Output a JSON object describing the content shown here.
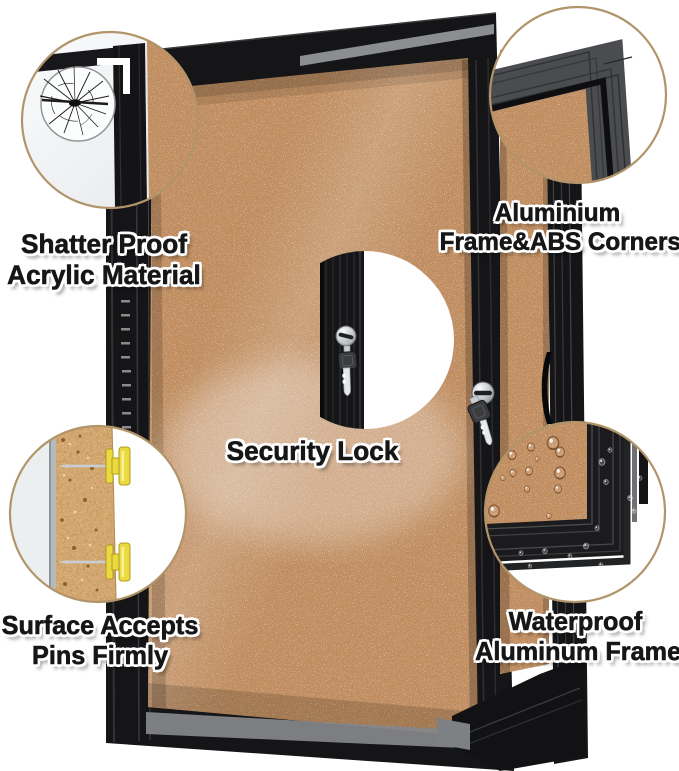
{
  "labels": {
    "shatter": {
      "line1": "Shatter Proof",
      "line2": "Acrylic Material"
    },
    "aluminium": {
      "line1": "Aluminium",
      "line2": "Frame&ABS Corners"
    },
    "security": {
      "label": "Security Lock"
    },
    "pins": {
      "line1": "Surface Accepts",
      "line2": "Pins Firmly"
    },
    "waterproof": {
      "line1": "Waterproof",
      "line2": "Aluminum Frame"
    }
  },
  "colors": {
    "background": "#ffffff",
    "cork": "#c08d60",
    "cork_section": "#d4a56c",
    "frame_black": "#151517",
    "aluminum_gray": "#4a4c4f",
    "circle_border": "#b2946a",
    "pin_yellow": "#ead93f",
    "lock_silver": "#c9ced3"
  },
  "icons": {
    "shattered-glass-icon": "spider-web crack pattern in acrylic",
    "aluminium-corner-icon": "mitered aluminium frame corner profile",
    "security-lock-icon": "round cam lock cylinder",
    "key-icon": "key hanging from lock",
    "push-pin-icon": "yellow push pin inserted in cork cross-section",
    "water-drop-icon": "water droplets beading on surface",
    "door-hinge-icon": "piano hinge on door edge",
    "door-handle-icon": "recessed door pull"
  }
}
